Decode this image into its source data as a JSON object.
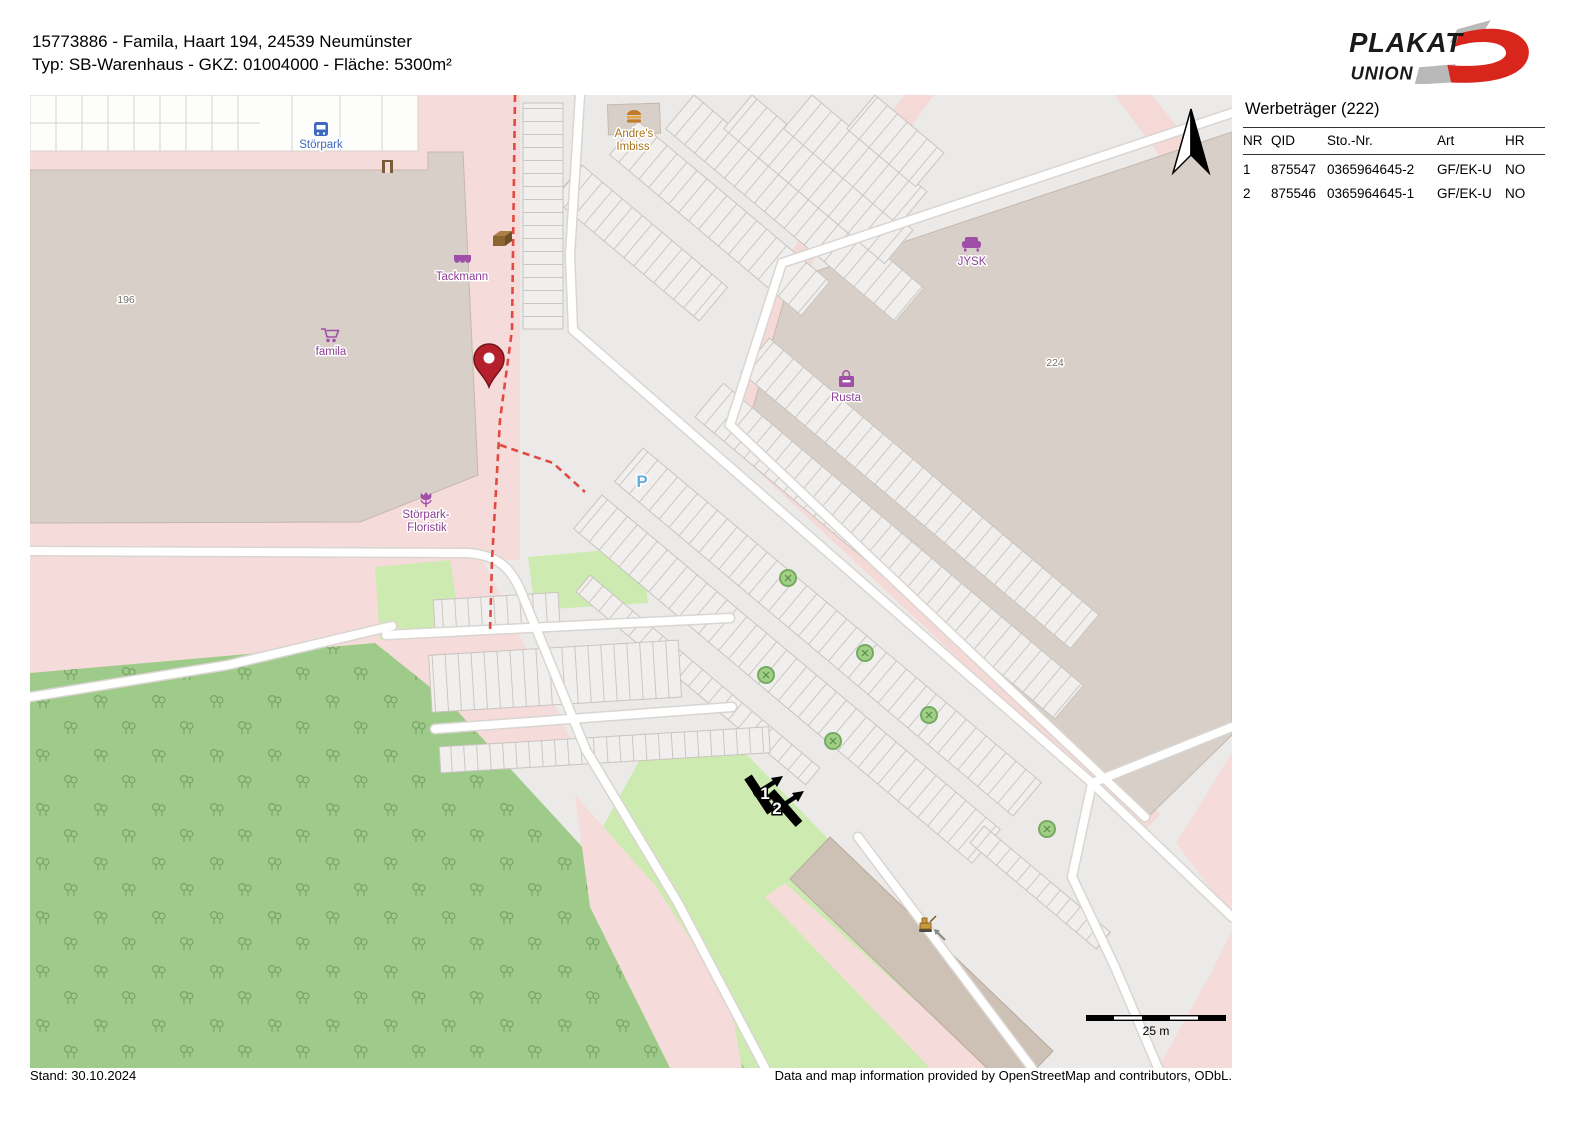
{
  "header": {
    "line1": "15773886 - Famila, Haart 194, 24539 Neumünster",
    "line2": "Typ: SB-Warenhaus - GKZ: 01004000 - Fläche: 5300m²"
  },
  "logo": {
    "plakat": "PLAKAT",
    "union": "UNION"
  },
  "sidebar": {
    "title": "Werbeträger (222)",
    "columns": [
      "NR",
      "QID",
      "Sto.-Nr.",
      "Art",
      "HR"
    ],
    "rows": [
      {
        "nr": "1",
        "qid": "875547",
        "sto": "0365964645-2",
        "art": "GF/EK-U",
        "hr": "NO"
      },
      {
        "nr": "2",
        "qid": "875546",
        "sto": "0365964645-1",
        "art": "GF/EK-U",
        "hr": "NO"
      }
    ]
  },
  "footer": {
    "stand": "Stand: 30.10.2024",
    "attribution": "Data and map information provided by OpenStreetMap and contributors, ODbL."
  },
  "map": {
    "labels": {
      "storpark": "Störpark",
      "tackmann": "Tackmann",
      "famila": "famila",
      "house196": "196",
      "floristik1": "Störpark-",
      "floristik2": "Floristik",
      "imbiss1": "Andre's",
      "imbiss2": "Imbiss",
      "jysk": "JYSK",
      "rusta": "Rusta",
      "house224": "224",
      "parking_p": "P",
      "marker1": "1",
      "marker2": "2",
      "scale": "25 m"
    },
    "colors": {
      "building": "#d8cfc8",
      "retail_pink": "#f5dbd9",
      "parking_gray": "#ebeae8",
      "forest_green": "#9ecb8a",
      "grass_green": "#cdebb0",
      "road_white": "#ffffff",
      "shop_purple": "#8d3f94",
      "amenity_orange": "#a8721f",
      "bus_blue": "#3f68c0",
      "parking_blue": "#64aede",
      "path_red_dashed": "#df4b42",
      "pin_red": "#b5202c",
      "logo_red": "#d9261c",
      "logo_gray": "#b9b9b9"
    }
  }
}
